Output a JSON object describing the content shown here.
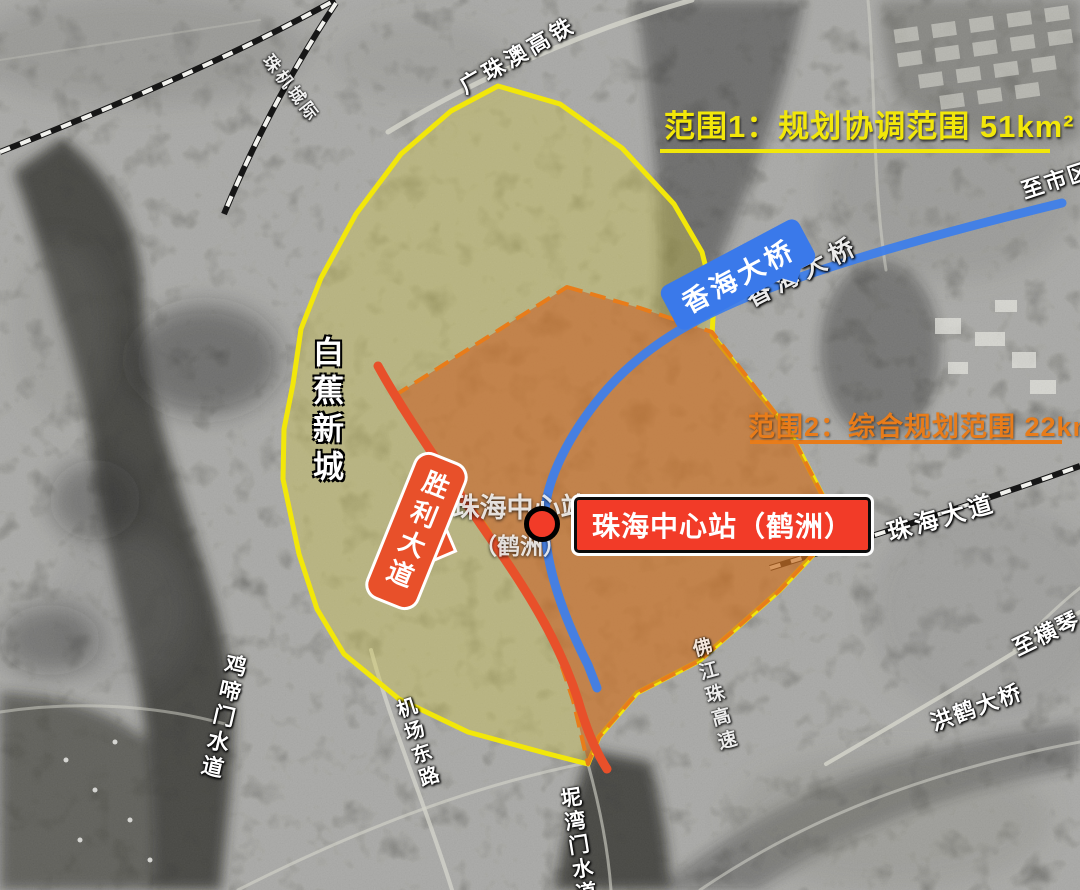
{
  "annotations": {
    "range1": "范围1：规划协调范围 51km²",
    "range2": "范围2：综合规划范围 22km²"
  },
  "badges": {
    "xianghai_bridge": "香海大桥",
    "shengli_avenue": "胜利大道",
    "station": "珠海中心站（鹤洲）",
    "station_ghost_line1": "珠海中心站",
    "station_ghost_line2": "（鹤洲）",
    "xianghai_bridge_road": "香海大桥"
  },
  "places": {
    "baijiao_new_town": "白蕉新城",
    "gzao_hsr": "广珠澳高铁",
    "zhuji_intercity": "珠机城际",
    "zhuhai_avenue": "珠海大道",
    "to_city": "至市区",
    "to_hengqin": "至横琴",
    "honghe_bridge": "洪鹤大桥",
    "jiti_waterway": "鸡啼门水道",
    "airport_east_road": "机场东路",
    "niwan_waterway": "坭湾门水道",
    "fjz_expressway": "佛江珠高速"
  },
  "colors": {
    "range1_line": "#f2e70a",
    "range2_line": "#e87c1a",
    "bridge_blue": "#3f80ea",
    "avenue_red": "#e8502a",
    "station_red": "#f23b28"
  }
}
